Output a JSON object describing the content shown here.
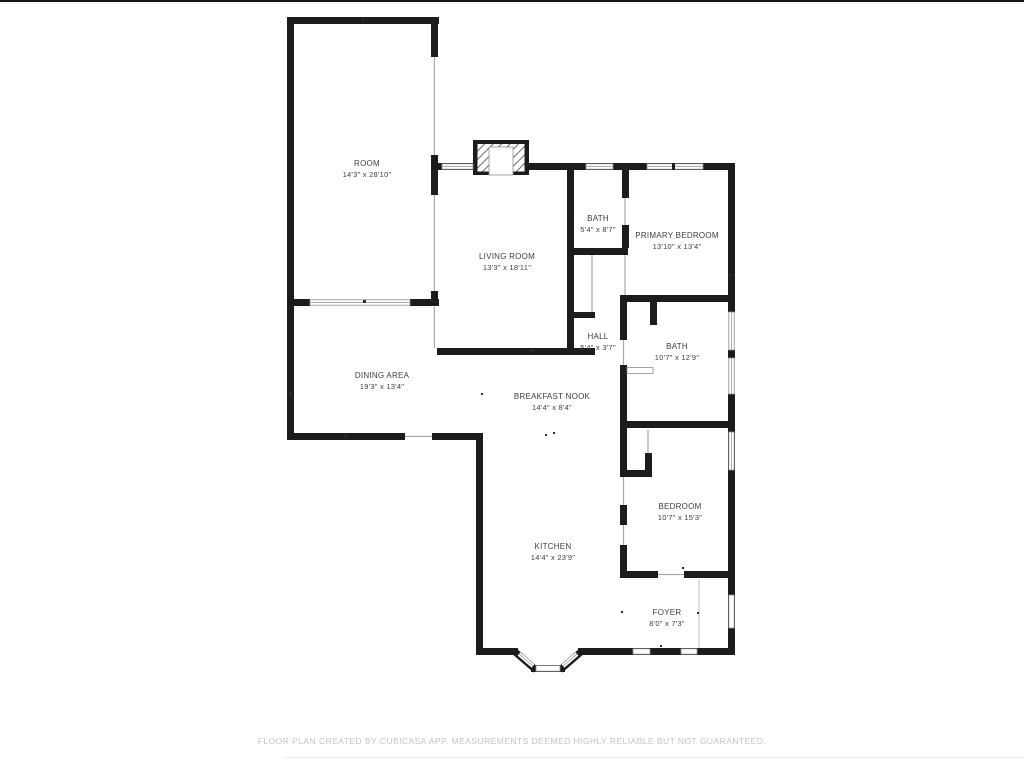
{
  "floor_plan": {
    "rooms": [
      {
        "name": "ROOM",
        "dims": "14'3\" x 28'10\""
      },
      {
        "name": "LIVING ROOM",
        "dims": "13'3\" x 18'11\""
      },
      {
        "name": "BATH",
        "dims": "5'4\" x 8'7\""
      },
      {
        "name": "PRIMARY BEDROOM",
        "dims": "13'10\" x 13'4\""
      },
      {
        "name": "HALL",
        "dims": "5'4\" x 3'7\""
      },
      {
        "name": "BATH",
        "dims": "10'7\" x 12'9\""
      },
      {
        "name": "DINING AREA",
        "dims": "19'3\" x 13'4\""
      },
      {
        "name": "BREAKFAST NOOK",
        "dims": "14'4\" x 8'4\""
      },
      {
        "name": "KITCHEN",
        "dims": "14'4\" x 23'9\""
      },
      {
        "name": "BEDROOM",
        "dims": "10'7\" x 15'3\""
      },
      {
        "name": "FOYER",
        "dims": "8'0\" x 7'3\""
      }
    ],
    "footer": "FLOOR PLAN CREATED BY CUBICASA APP. MEASUREMENTS DEEMED HIGHLY RELIABLE BUT NOT GUARANTEED.",
    "colors": {
      "wall": "#1c1c1c",
      "label": "#3d3d3d",
      "footer": "#c4c4c4",
      "background": "#ffffff"
    }
  }
}
